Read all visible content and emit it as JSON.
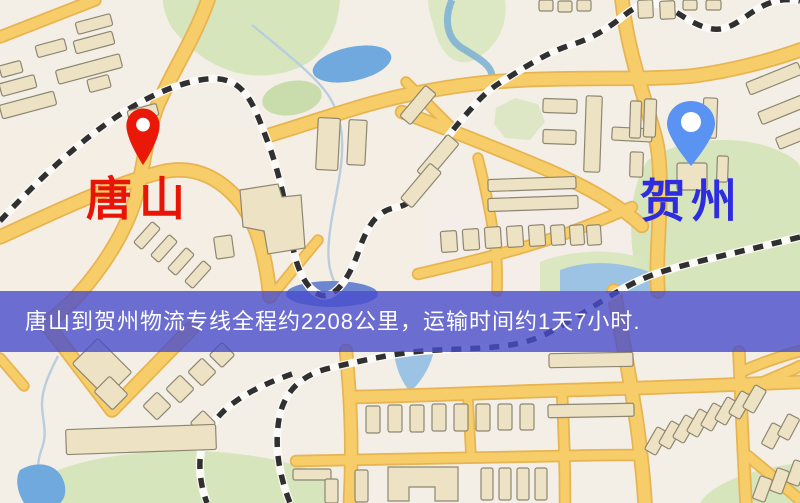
{
  "banner": {
    "text": "唐山到贺州物流专线全程约2208公里，运输时间约1天7小时."
  },
  "markers": {
    "origin": {
      "label": "唐山",
      "pin_icon": "red-location-pin"
    },
    "destination": {
      "label": "贺州",
      "pin_icon": "blue-location-pin"
    }
  },
  "colors": {
    "banner_bg": "rgba(72,76,202,0.8)",
    "banner_text": "#ffffff",
    "origin_label": "#e81405",
    "dest_label": "#2d2ddf",
    "pin_origin": "#ea1808",
    "pin_dest": "#5b93f2",
    "road_fill": "#f6cd68",
    "road_casing": "#e8b451",
    "water": "#6fa9de",
    "park": "#d7e5bd",
    "map_base": "#f3efe6",
    "building_fill": "#ede3c4",
    "building_stroke": "#8d8672",
    "rail_dark": "#303030"
  }
}
